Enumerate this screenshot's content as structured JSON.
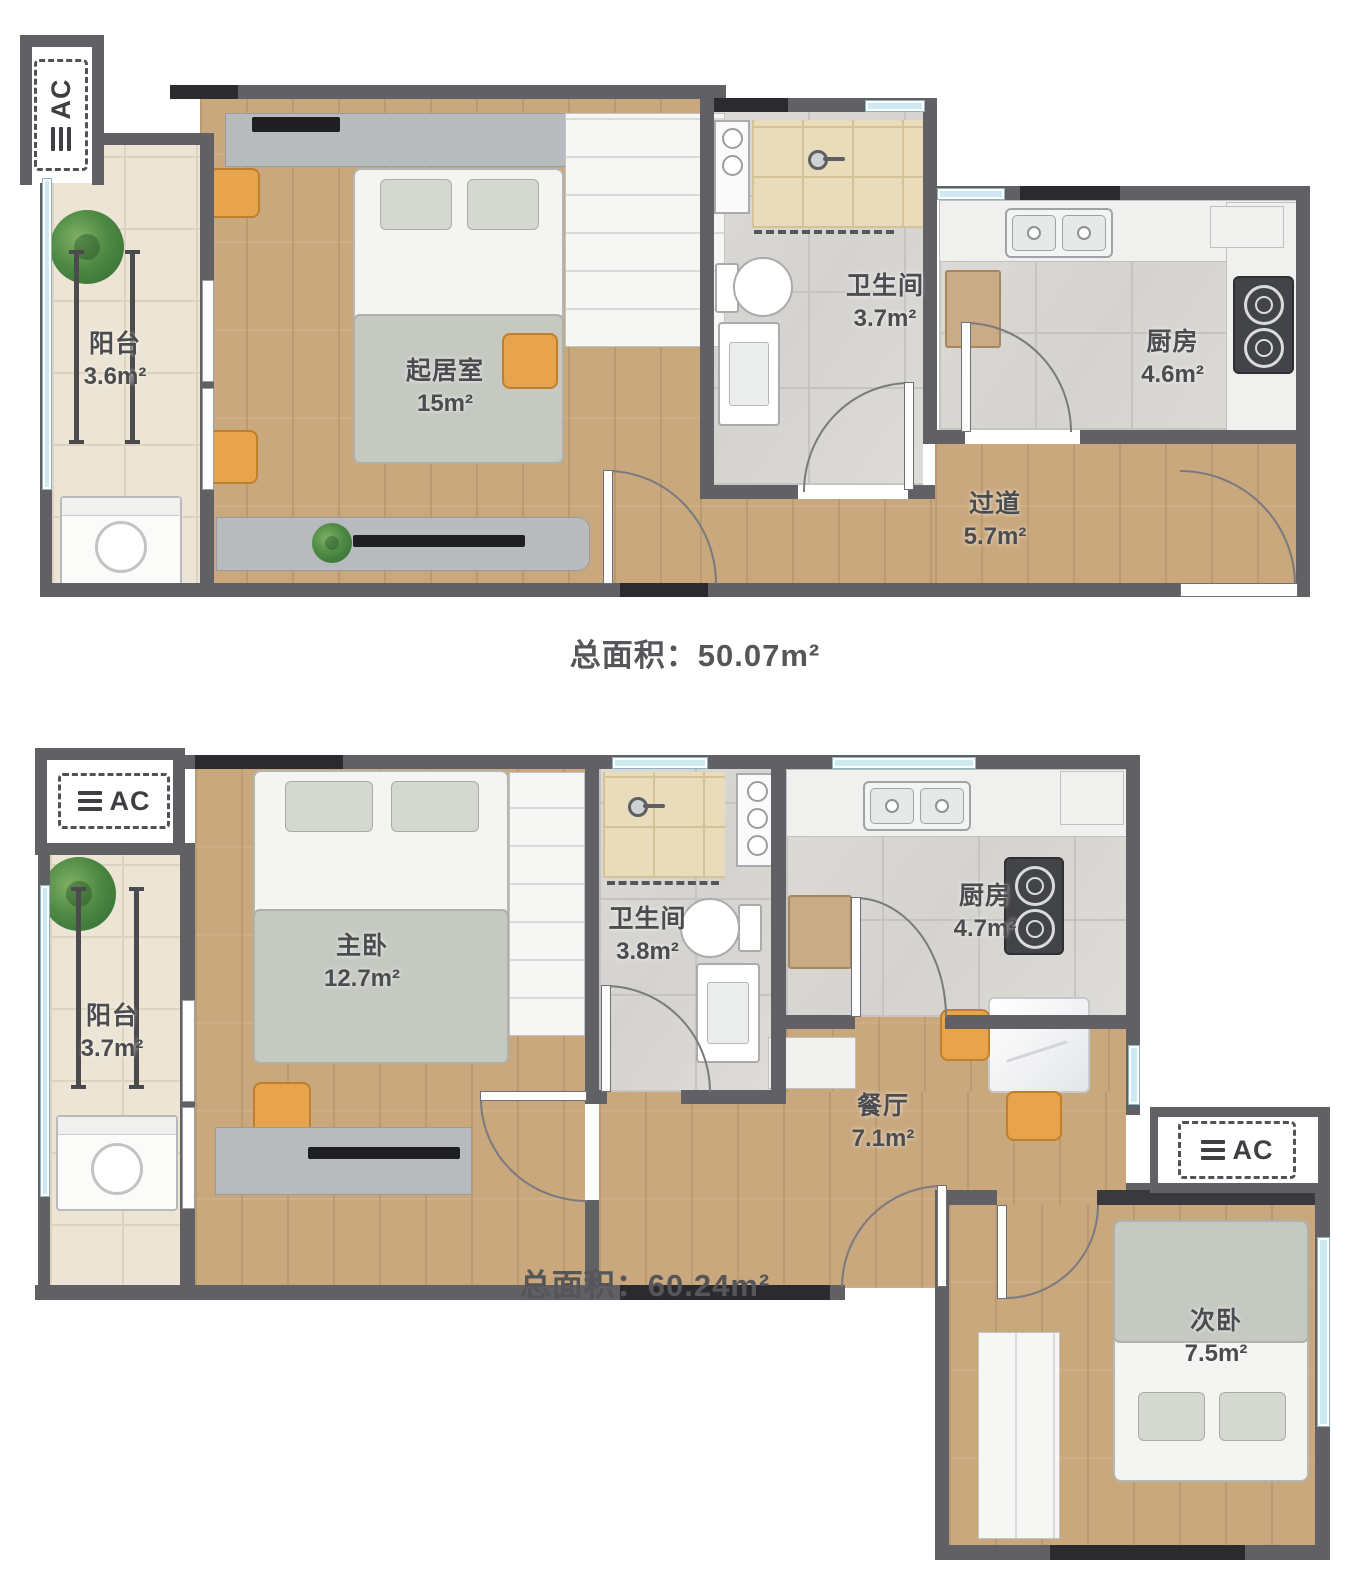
{
  "ac_label": "AC",
  "plans": [
    {
      "name": "plan-a",
      "total_label": "总面积：",
      "total_value": "50.07m²",
      "rooms": [
        {
          "name": "阳台",
          "area": "3.6m²"
        },
        {
          "name": "起居室",
          "area": "15m²"
        },
        {
          "name": "卫生间",
          "area": "3.7m²"
        },
        {
          "name": "厨房",
          "area": "4.6m²"
        },
        {
          "name": "过道",
          "area": "5.7m²"
        }
      ]
    },
    {
      "name": "plan-b",
      "total_label": "总面积：",
      "total_value": "60.24m²",
      "rooms": [
        {
          "name": "阳台",
          "area": "3.7m²"
        },
        {
          "name": "主卧",
          "area": "12.7m²"
        },
        {
          "name": "卫生间",
          "area": "3.8m²"
        },
        {
          "name": "厨房",
          "area": "4.7m²"
        },
        {
          "name": "餐厅",
          "area": "7.1m²"
        },
        {
          "name": "次卧",
          "area": "7.5m²"
        }
      ]
    }
  ],
  "colors": {
    "wall": "#606065",
    "wall_dark": "#2b2b2f",
    "wood_floor": "#c9a87e",
    "balcony_tile": "#ece4d4",
    "marble_tile": "#d8d6d2",
    "shower_tile": "#e9dcba",
    "window_glass": "#cdeaf2",
    "accent_orange": "#e7a44d",
    "label_text": "#4b4c50"
  }
}
